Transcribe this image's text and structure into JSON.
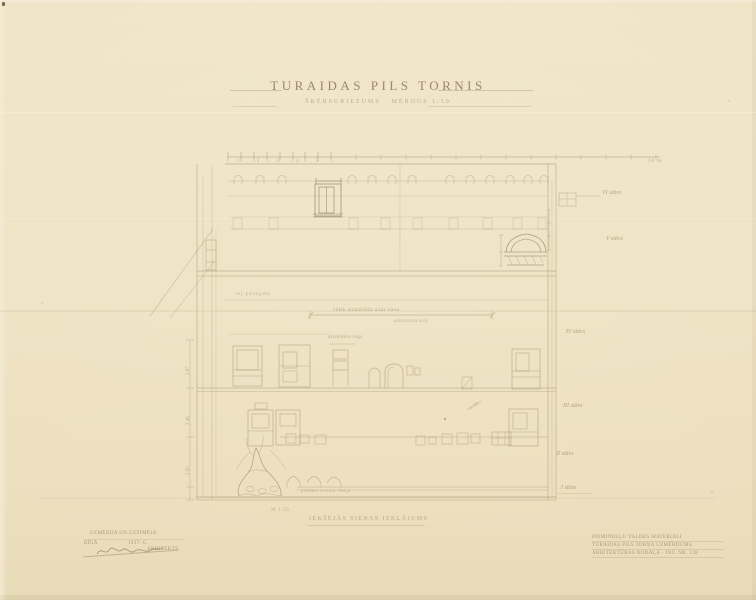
{
  "colors": {
    "paper": "#efe3c4",
    "paper-edge": "#e6d9b4",
    "pencil": "#8f7c5c",
    "pencil-dark": "#6e5e44",
    "ink": "#8a7354"
  },
  "title": {
    "main": "TURAIDAS PILS TORNIS",
    "sub": "ŠĶĒRSGRIEZUMS · MĒROGS 1:50"
  },
  "captions": {
    "drawing": "IEKŠĒJĀS SIENAS IZKLĀJUMS",
    "scale_note": "M 1:50"
  },
  "scalebar": {
    "numbers": "1 2 3 4 5",
    "end": "10 m"
  },
  "floors": [
    "VI stāvs",
    "V stāvs",
    "IV stāvs",
    "III stāvs",
    "II stāvs",
    "I stāvs"
  ],
  "annotations": {
    "blocked_opening": "vēlāk aizmūrētās ailas vieta",
    "blocked_opening_sub": "aizmūrēta aila",
    "walled_window": "aizmūrēts logs",
    "former_ceiling": "bij. pārsegums",
    "dim_note": "1.33",
    "ground_note": "pamatu virsējā līnija"
  },
  "dimensions": {
    "d1": "2.87",
    "d2": "2.46",
    "d3": "2.60"
  },
  "stamp_left": {
    "line1": "UZMĒRĪJA UN UZZĪMĒJA",
    "place": "RĪGĀ",
    "year": "1937. G.",
    "role": "ARHITEKTS"
  },
  "stamp_right": {
    "line1": "PIEMINEKĻU VALDES MATERIĀLI",
    "line2": "TURAIDAS PILS TORŅA UZMĒRĪJUMS",
    "line3": "ARHITEKTŪRAS NODAĻA · INV. NR. 138"
  }
}
